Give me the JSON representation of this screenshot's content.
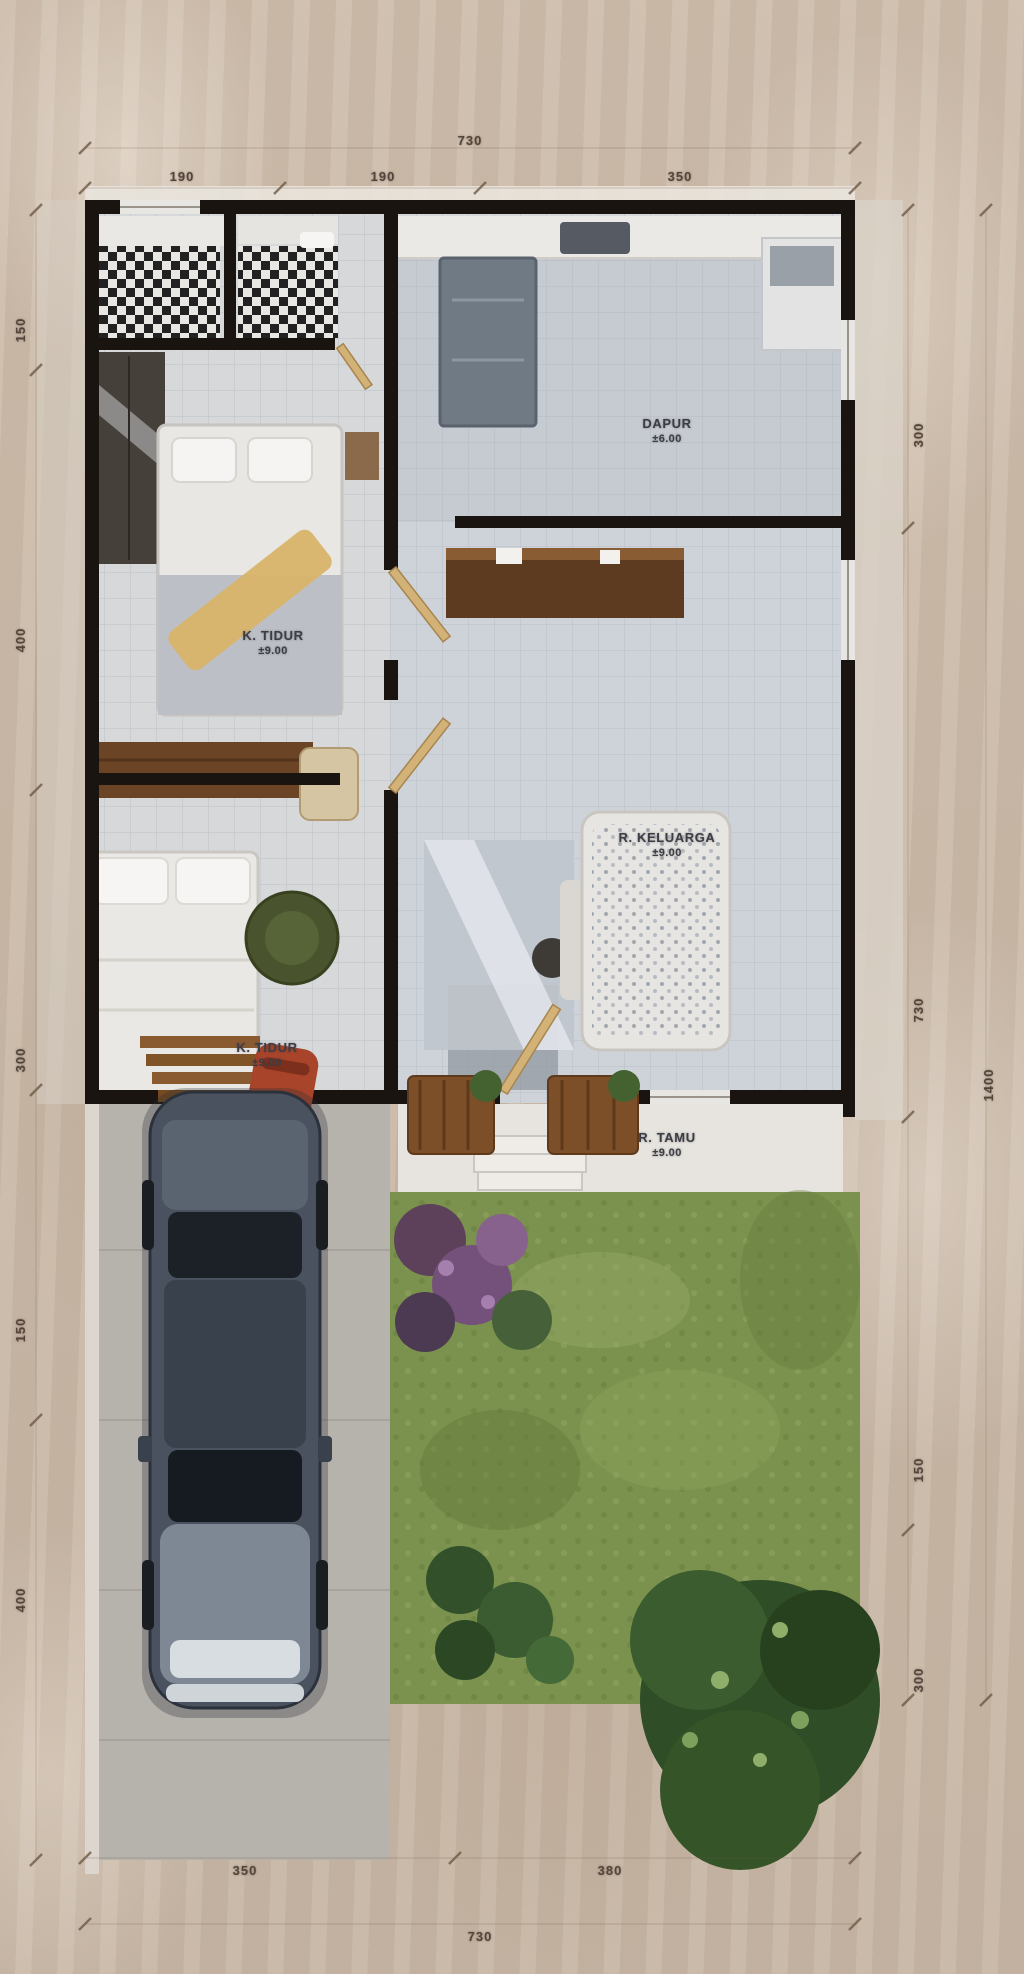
{
  "plan_type": "house-floor-plan-top-view",
  "dimensions": {
    "top": {
      "total": "730",
      "segments": [
        "190",
        "190",
        "350"
      ]
    },
    "bottom": {
      "total": "730",
      "segments": [
        "350",
        "380"
      ]
    },
    "left": {
      "segments": [
        "150",
        "400",
        "300",
        "150",
        "400"
      ]
    },
    "right": {
      "segments": [
        "300",
        "730",
        "150",
        "300"
      ],
      "total": "1400"
    }
  },
  "rooms": {
    "dapur": {
      "name": "DAPUR",
      "area": "±6.00"
    },
    "tidur1": {
      "name": "K. TIDUR",
      "area": "±9.00"
    },
    "keluarga": {
      "name": "R. KELUARGA",
      "area": "±9.00"
    },
    "tidur2": {
      "name": "K. TIDUR",
      "area": "±9.00"
    },
    "tamu": {
      "name": "R. TAMU",
      "area": "±9.00"
    }
  },
  "colors": {
    "background": "#cbbaa9",
    "wall": "#1a1410",
    "floor_tile": "#d6d8da",
    "kitchen_floor": "#c6cbd1",
    "grass": "#7b914e",
    "wood": "#8a5a30",
    "label_text": "#4a3d33"
  }
}
